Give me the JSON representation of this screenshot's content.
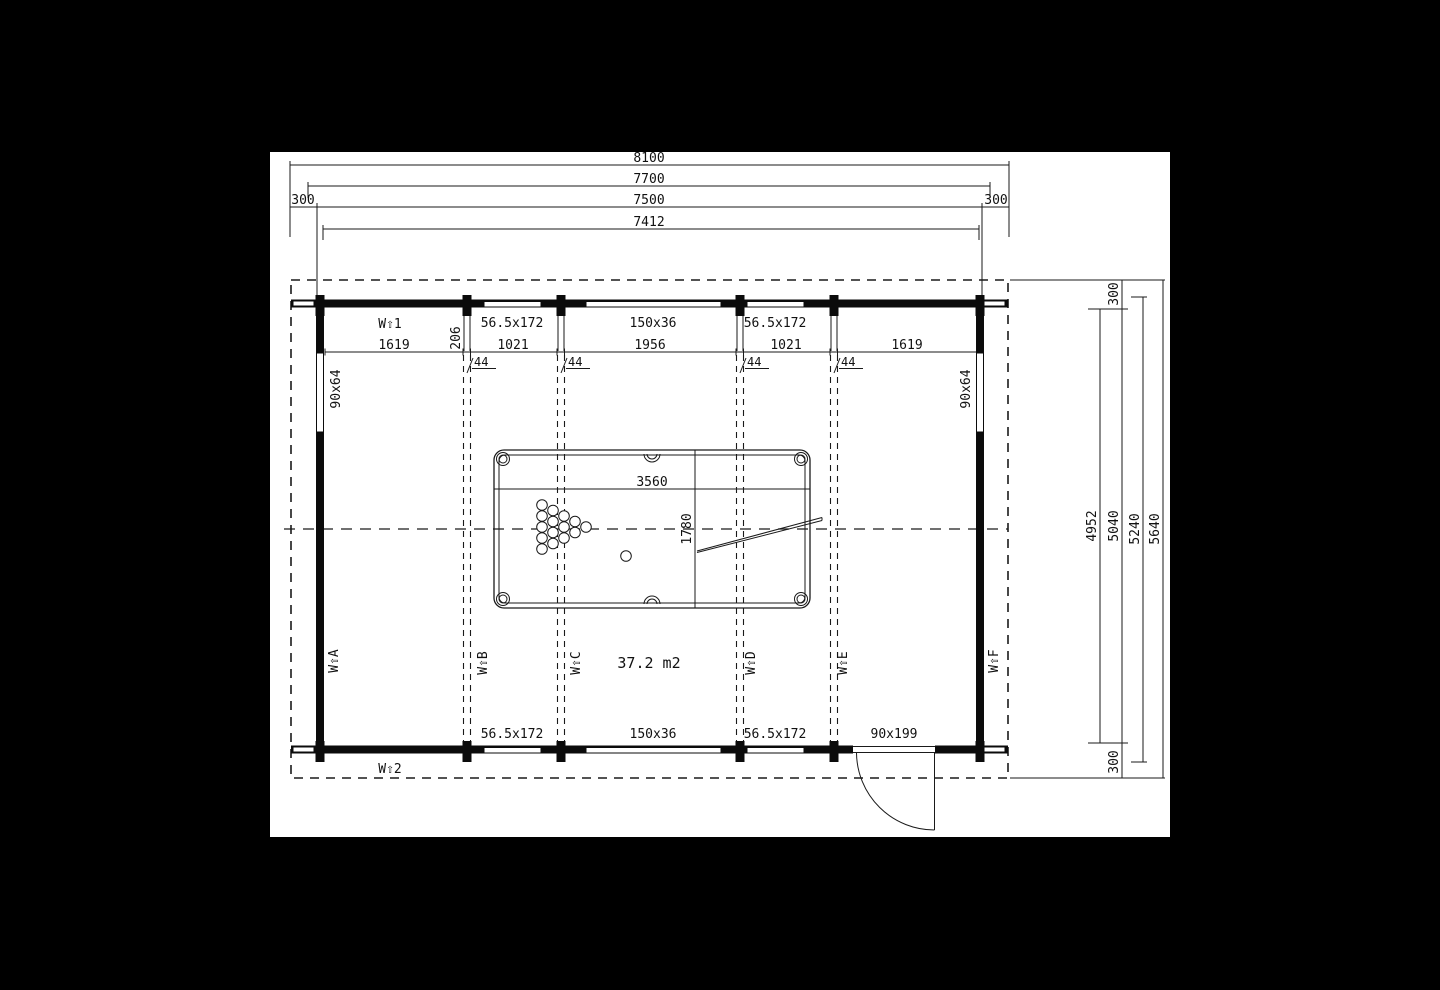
{
  "dims_top": {
    "overall": "8100",
    "roof": "7700",
    "wall": "7500",
    "inner": "7412",
    "left_overhang": "300",
    "right_overhang": "300"
  },
  "dims_right": {
    "inner": "4952",
    "wall": "5040",
    "roof": "5240",
    "overall": "5640",
    "top_overhang": "300",
    "bottom_overhang": "300"
  },
  "top_wall": {
    "marker": "W⇧1",
    "windows": [
      "56.5x172",
      "150x36",
      "56.5x172"
    ],
    "bay_dims": [
      "1619",
      "206",
      "1021",
      "1956",
      "1021",
      "1619"
    ],
    "post_dims": [
      "44",
      "44",
      "44",
      "44"
    ]
  },
  "bottom_wall": {
    "marker": "W⇧2",
    "windows": [
      "56.5x172",
      "150x36",
      "56.5x172"
    ],
    "door": "90x199"
  },
  "side_walls": {
    "left_window": "90x64",
    "right_window": "90x64"
  },
  "room": {
    "area": "37.2 m2",
    "markers": [
      "W⇧A",
      "W⇧B",
      "W⇧C",
      "W⇧D",
      "W⇧E",
      "W⇧F"
    ]
  },
  "pool_table": {
    "length": "3560",
    "width": "1780"
  }
}
